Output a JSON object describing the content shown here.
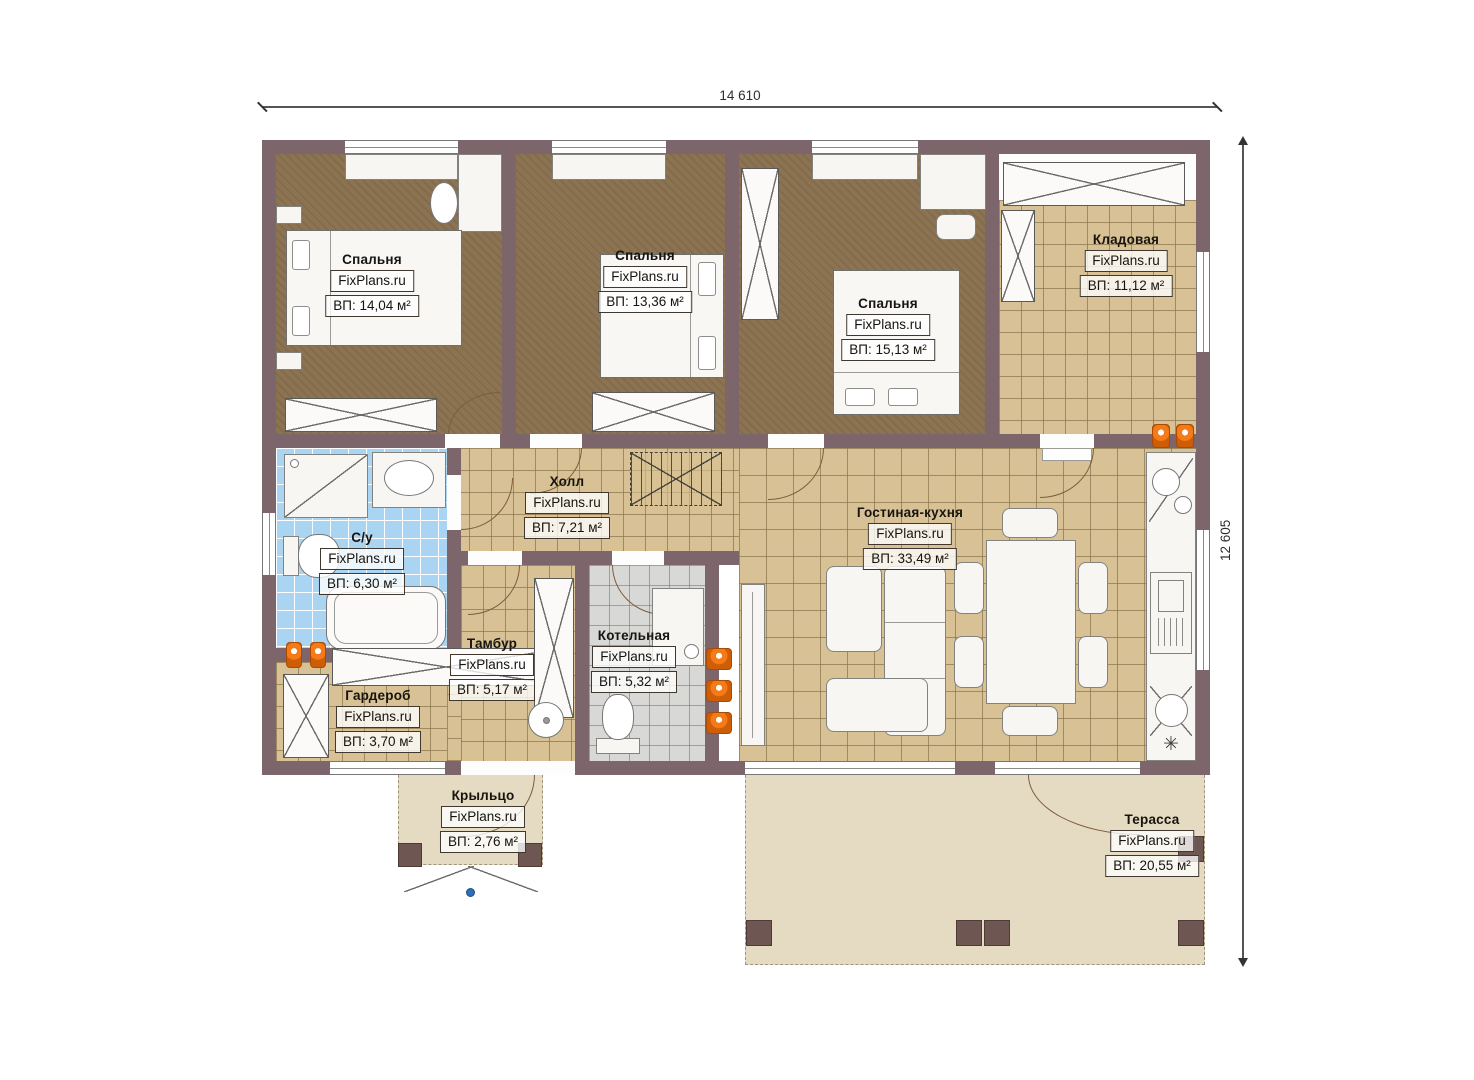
{
  "watermark": "FixPlans.ru",
  "dimensions": {
    "top": "14 610",
    "right": "12 605"
  },
  "rooms": [
    {
      "name": "Спальня",
      "watermark": "FixPlans.ru",
      "area": "ВП: 14,04 м²"
    },
    {
      "name": "Спальня",
      "watermark": "FixPlans.ru",
      "area": "ВП: 13,36 м²"
    },
    {
      "name": "Спальня",
      "watermark": "FixPlans.ru",
      "area": "ВП: 15,13 м²"
    },
    {
      "name": "Кладовая",
      "watermark": "FixPlans.ru",
      "area": "ВП: 11,12 м²"
    },
    {
      "name": "Холл",
      "watermark": "FixPlans.ru",
      "area": "ВП: 7,21 м²"
    },
    {
      "name": "С/у",
      "watermark": "FixPlans.ru",
      "area": "ВП: 6,30 м²"
    },
    {
      "name": "Гостиная-кухня",
      "watermark": "FixPlans.ru",
      "area": "ВП: 33,49 м²"
    },
    {
      "name": "Тамбур",
      "watermark": "FixPlans.ru",
      "area": "ВП: 5,17 м²"
    },
    {
      "name": "Котельная",
      "watermark": "FixPlans.ru",
      "area": "ВП: 5,32 м²"
    },
    {
      "name": "Гардероб",
      "watermark": "FixPlans.ru",
      "area": "ВП: 3,70 м²"
    },
    {
      "name": "Крыльцо",
      "watermark": "FixPlans.ru",
      "area": "ВП: 2,76 м²"
    },
    {
      "name": "Терасса",
      "watermark": "FixPlans.ru",
      "area": "ВП: 20,55 м²"
    }
  ],
  "icons": {
    "freezer": "✳"
  },
  "colors": {
    "wall": "#7c666b",
    "bedroom_floor": "#8c7452",
    "tile_floor": "#d8c295",
    "bath_tile": "#a9d4f2",
    "boiler_tile": "#d8d8d6",
    "deck": "#e5dac2",
    "radiator": "#f47b17",
    "dimension_text": "#2f2f2f"
  }
}
